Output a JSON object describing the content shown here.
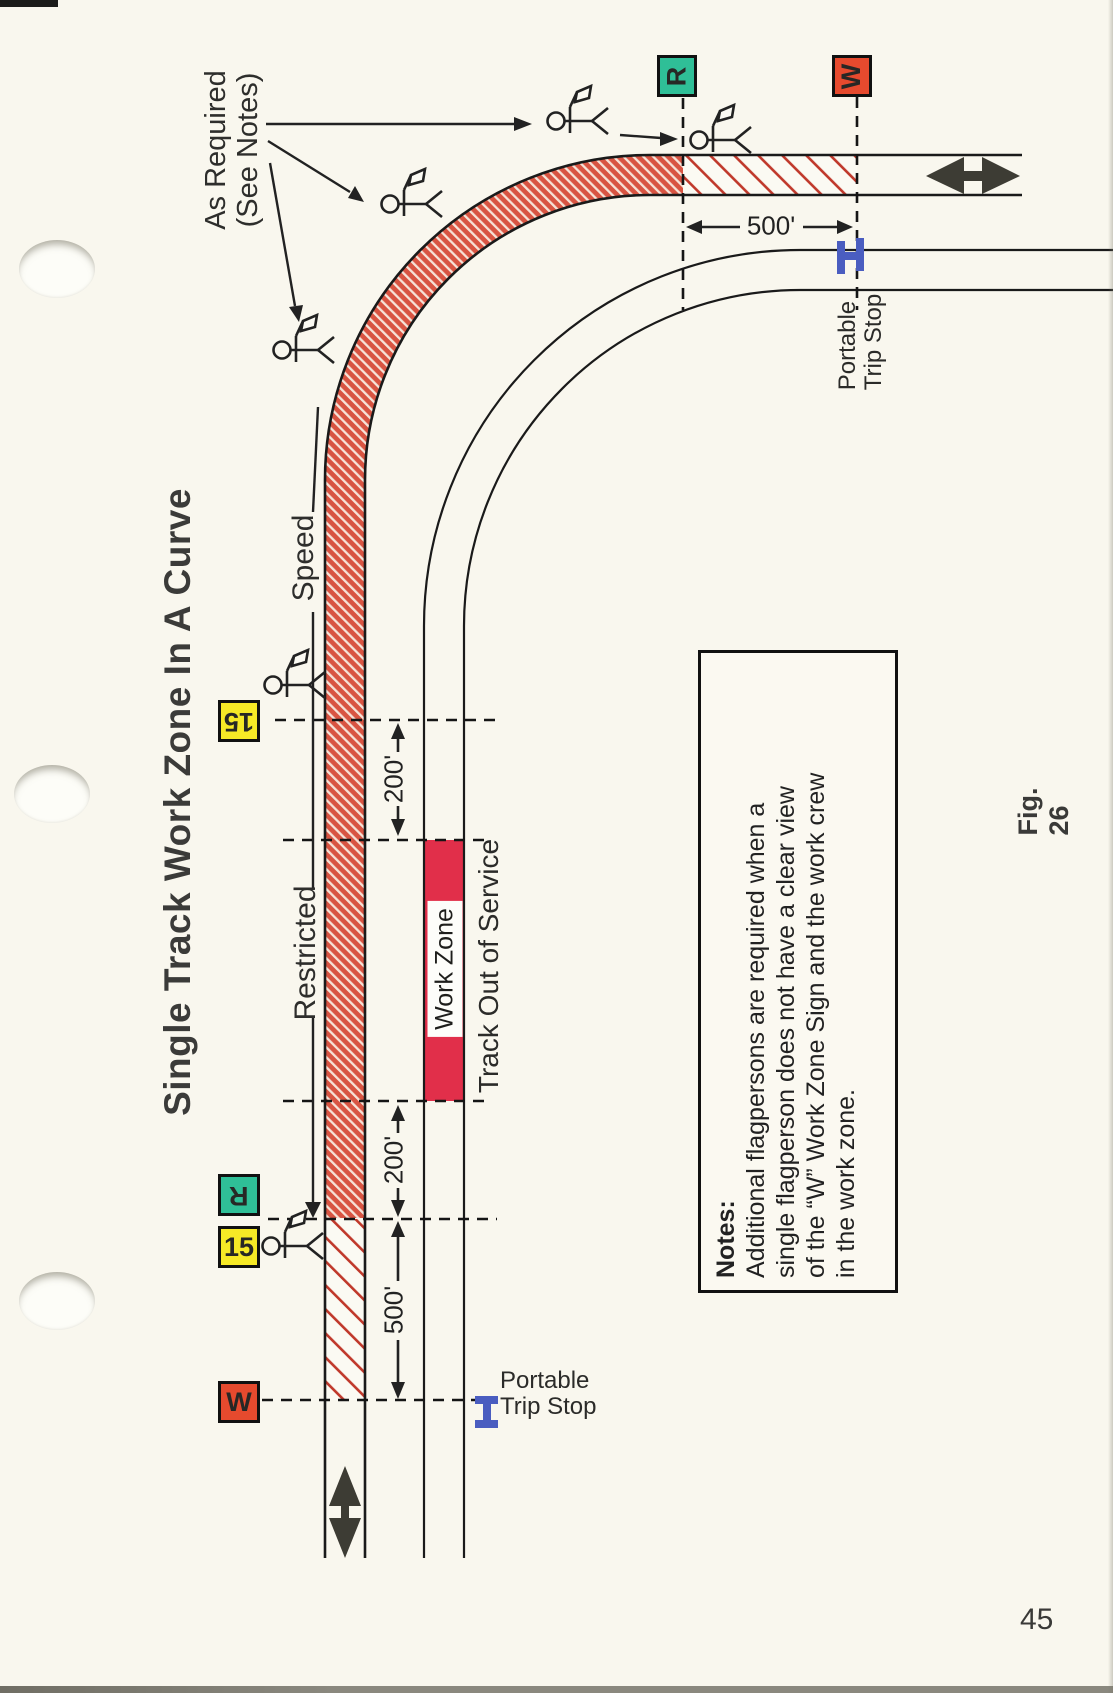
{
  "page": {
    "title": "Single Track Work Zone In A Curve",
    "figure_label": "Fig. 26",
    "page_number": "45"
  },
  "signs": {
    "restricted_letter": "R",
    "work_zone_letter": "W",
    "speed_number": "15"
  },
  "labels": {
    "as_required": [
      "As Required",
      "(See Notes)"
    ],
    "speed": "Speed",
    "restricted": "Restricted",
    "work_zone_bar": "Work Zone",
    "track_out_of_service": "Track Out of Service",
    "portable_trip_stop": [
      "Portable",
      "Trip Stop"
    ]
  },
  "dimensions": {
    "top_approach": "500'",
    "upper_buffer": "200'",
    "lower_buffer": "200'",
    "bottom_approach": "500'"
  },
  "notes": {
    "heading": "Notes:",
    "lines": [
      "Additional flagpersons are required when a",
      "single flagperson does not have a clear view",
      "of the “W” Work Zone Sign and the work crew",
      "in the work zone."
    ]
  },
  "colors": {
    "restricted_hatch": "#d85442",
    "light_hatch_line": "#c0392b",
    "work_zone_bar": "#e12f4a",
    "sign_green": "#2fbf97",
    "sign_yellow": "#f6e926",
    "sign_red": "#e64a2e",
    "trip_stop_blue": "#4a5dc0"
  }
}
